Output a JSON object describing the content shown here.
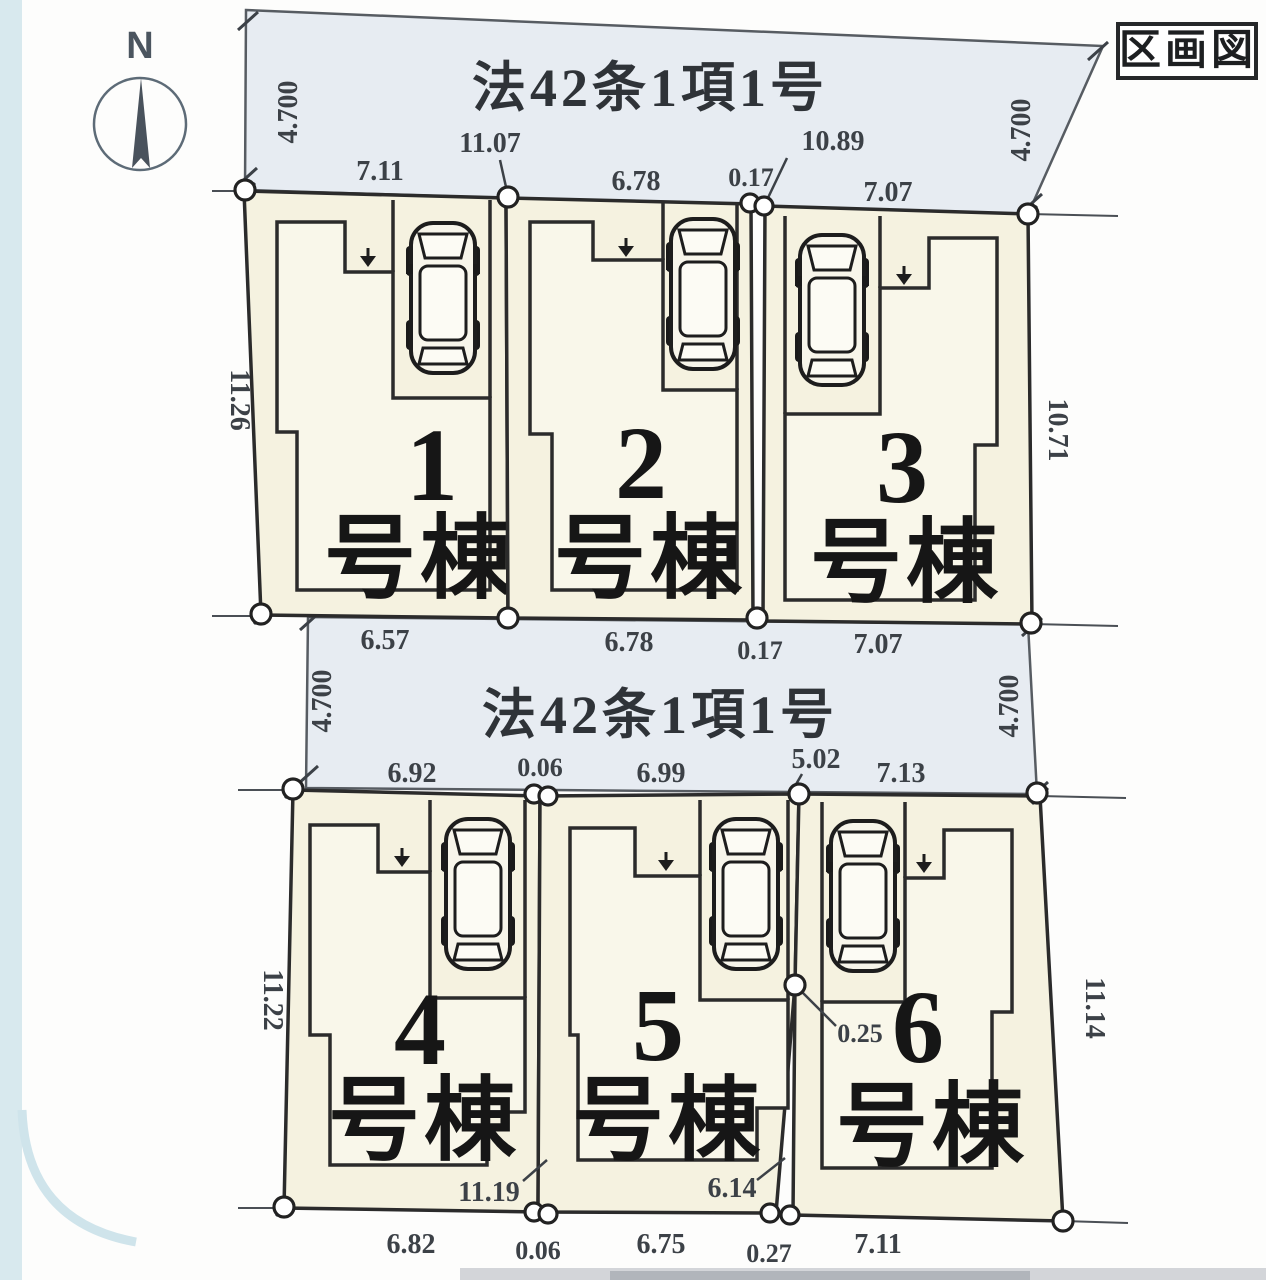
{
  "figure": {
    "title_box_label": "区画図",
    "compass_label": "N"
  },
  "roads": {
    "top": {
      "label": "法42条1項1号",
      "width_left": "4.700",
      "width_right": "4.700"
    },
    "middle": {
      "label": "法42条1項1号",
      "width_left": "4.700",
      "width_right": "4.700"
    }
  },
  "lots": [
    {
      "number": "1",
      "suffix": "号棟"
    },
    {
      "number": "2",
      "suffix": "号棟"
    },
    {
      "number": "3",
      "suffix": "号棟"
    },
    {
      "number": "4",
      "suffix": "号棟"
    },
    {
      "number": "5",
      "suffix": "号棟"
    },
    {
      "number": "6",
      "suffix": "号棟"
    }
  ],
  "dims": {
    "top_edge": [
      "7.11",
      "11.07",
      "6.78",
      "0.17",
      "10.89",
      "7.07"
    ],
    "row1_bottom": [
      "6.57",
      "6.78",
      "0.17",
      "7.07"
    ],
    "row1_left": "11.26",
    "row1_right": "10.71",
    "mid_bottom": [
      "6.92",
      "0.06",
      "6.99",
      "5.02",
      "7.13"
    ],
    "row2_left": "11.22",
    "row2_right": "11.14",
    "row2_internal": [
      "11.19",
      "6.14",
      "0.25"
    ],
    "row2_bottom": [
      "6.82",
      "0.06",
      "6.75",
      "0.27",
      "7.11"
    ]
  },
  "colors": {
    "road_fill": "#e7ecf2",
    "lot_fill": "#f5f2e0",
    "building_fill": "#f9f7ea",
    "line": "#2b2b2b",
    "panel_blue": "#d8e9ee"
  }
}
